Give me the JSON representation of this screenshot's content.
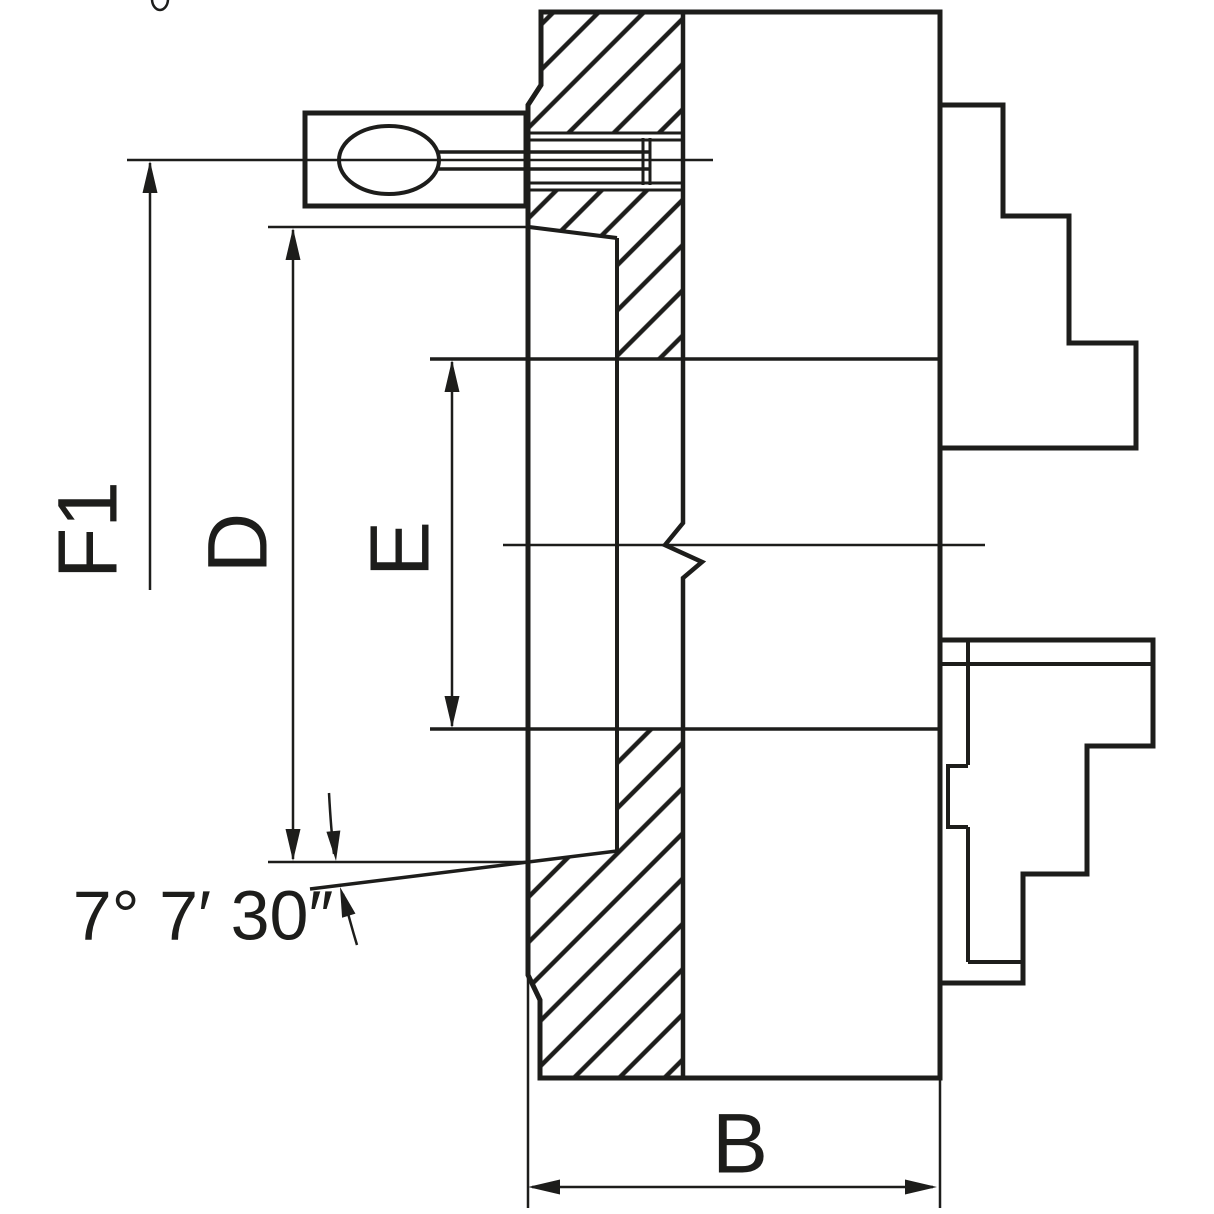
{
  "drawing": {
    "type": "lathe-chuck-cross-section",
    "labels": {
      "f1": "F1",
      "d": "D",
      "e": "E",
      "b": "B",
      "angle": "7° 7′ 30″"
    },
    "colors": {
      "line": "#1d1d1b",
      "background": "#ffffff"
    },
    "decorations": {
      "top_edge_fragment": "partial-circle-glyph"
    }
  }
}
